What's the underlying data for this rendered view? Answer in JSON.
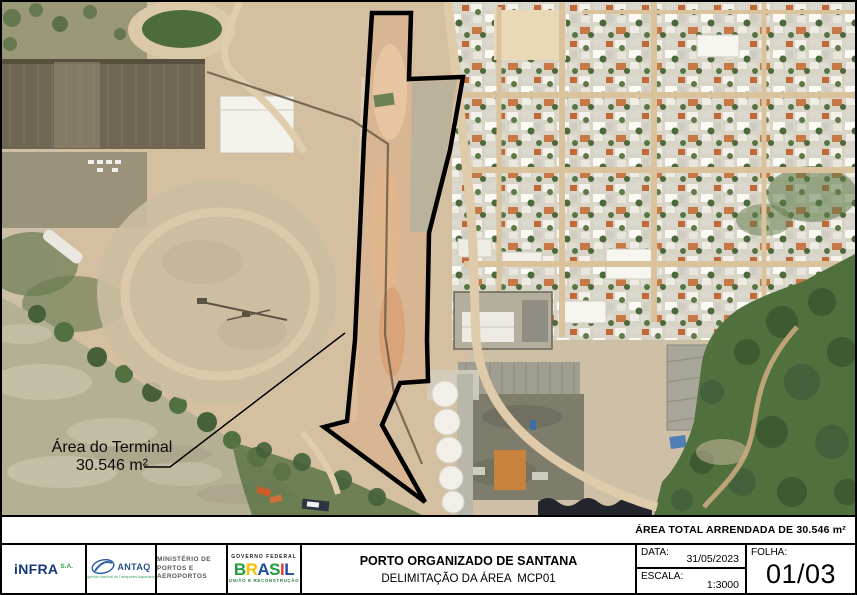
{
  "map": {
    "terminal_label_line1": "Área do Terminal",
    "terminal_label_line2": "30.546 m²"
  },
  "footer": {
    "area_total_note": "ÁREA TOTAL ARRENDADA DE 30.546 m²"
  },
  "logos": {
    "infra_name": "iNFRA",
    "infra_suffix": "S.A.",
    "antaq_name": "ANTAQ",
    "antaq_subtitle": "Agência Nacional de Transportes Aquaviários",
    "ministerio_line1": "MINISTÉRIO DE",
    "ministerio_line2": "PORTOS E AEROPORTOS",
    "governo_top": "GOVERNO FEDERAL",
    "governo_name": "BRASIL",
    "governo_bottom": "UNIÃO E RECONSTRUÇÃO",
    "brasil_letter_colors": [
      "#1f9c3c",
      "#f3c300",
      "#1d4f9e",
      "#1f9c3c",
      "#e03c31",
      "#1d4f9e"
    ]
  },
  "title_block": {
    "title": "PORTO ORGANIZADO DE SANTANA",
    "subtitle": "DELIMITAÇÃO DA ÁREA  MCP01",
    "date_label": "DATA:",
    "date_value": "31/05/2023",
    "scale_label": "ESCALA:",
    "scale_value": "1:3000",
    "sheet_label": "FOLHA:",
    "sheet_value": "01/03"
  }
}
